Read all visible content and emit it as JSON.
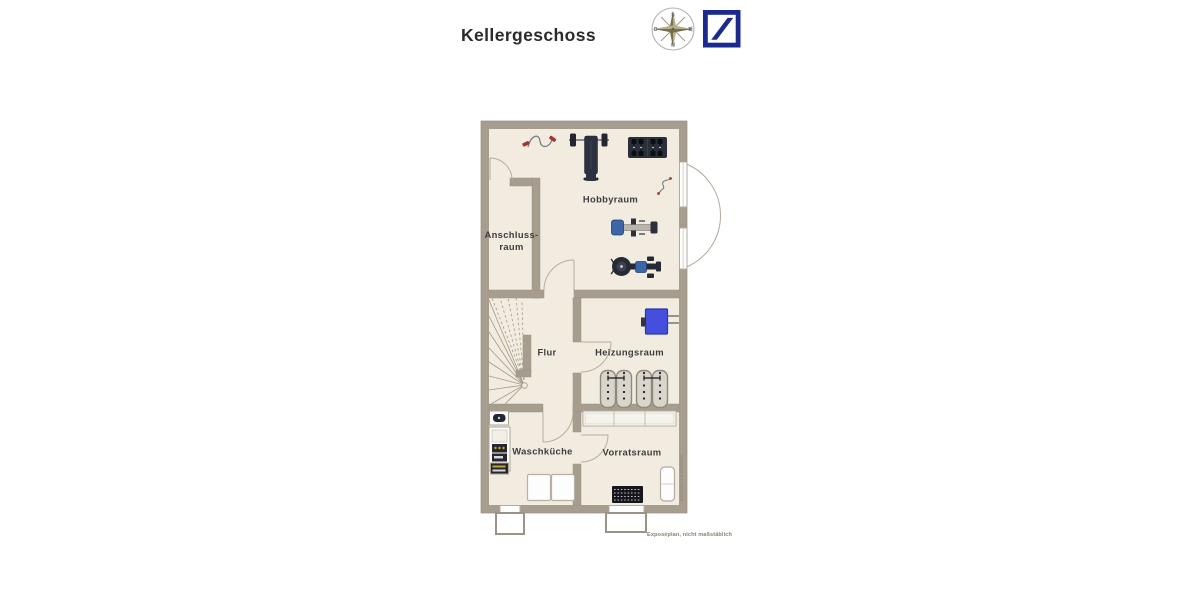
{
  "header": {
    "title": "Kellergeschoss"
  },
  "compass": {
    "top": "S",
    "right": "W",
    "bottom": "N",
    "left": "O"
  },
  "logo": {
    "name": "bank-slash-logo",
    "color": "#1b2a8f"
  },
  "floorplan": {
    "rooms": {
      "hobbyraum": "Hobbyraum",
      "anschlussraum_line1": "Anschluss-",
      "anschlussraum_line2": "raum",
      "flur": "Flur",
      "heizungsraum": "Heizungsraum",
      "waschkueche": "Waschküche",
      "vorratsraum": "Vorratsraum"
    },
    "colors": {
      "wall": "#a79d8f",
      "floor": "#f1ecdf",
      "heater_blue": "#4450dd",
      "equipment_dark": "#2b2f3a",
      "accent_blue": "#3b66a8",
      "accent_red": "#9e3732"
    },
    "icons": [
      "compass-icon",
      "jump-rope-icon",
      "bench-press-icon",
      "dumbbell-rack-icon",
      "resistance-band-icon",
      "rowing-machine-icon",
      "exercise-bike-icon",
      "stairs-icon",
      "boiler-icon",
      "tank-battery-icon",
      "sink-icon",
      "washer-dryer-stack-icon",
      "washing-machines-icon",
      "shelf-icon",
      "doormat-icon",
      "radiator-icon",
      "door-swing-icon",
      "window-icon",
      "light-well-icon"
    ]
  },
  "footer": {
    "note": "Exposéplan, nicht maßstäblich"
  },
  "watermark": "Exposéplan, nicht maßstäblich"
}
